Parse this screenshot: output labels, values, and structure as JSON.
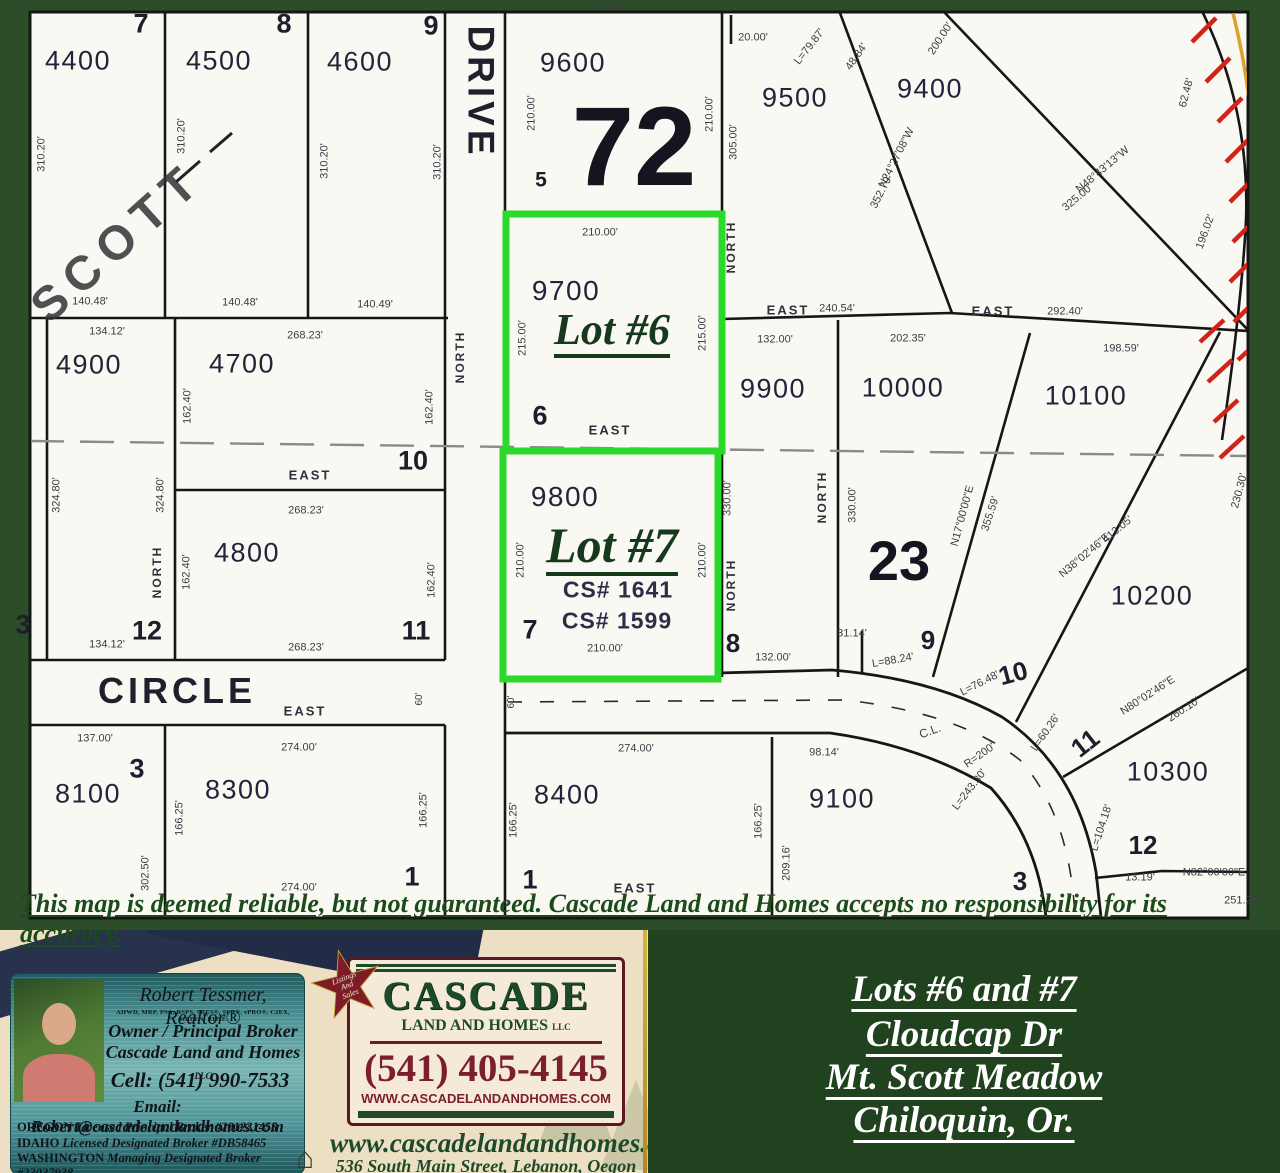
{
  "colors": {
    "frame_green": "#2b4e29",
    "panel_green": "#20421f",
    "paper": "#f9f8f3",
    "line_black": "#161616",
    "highlight_green": "#2bd92b",
    "hatch_red": "#cf2518",
    "boundary_orange": "#dea02b",
    "lot_green_text": "#16391b",
    "maroon": "#7b1f2e",
    "brand_green": "#1c4a2a",
    "cream": "#ecdfc3",
    "card_teal": "#4f9396"
  },
  "map": {
    "disclaimer": "This map is deemed reliable, but not guaranteed. Cascade Land and Homes accepts no responsibility for its accuracy.",
    "highlighted_lots": [
      {
        "label": "Lot #6",
        "parcel": "9700"
      },
      {
        "label": "Lot #7",
        "parcel": "9800"
      }
    ],
    "labels": [
      {
        "t": "DRIVE",
        "x": 481,
        "y": 92,
        "s": 37,
        "r": 90,
        "c": "street"
      },
      {
        "t": "CIRCLE",
        "x": 177,
        "y": 691,
        "s": 36,
        "c": "street"
      },
      {
        "t": "SCOTT",
        "x": 118,
        "y": 243,
        "s": 48,
        "r": -42,
        "c": "scott"
      },
      {
        "t": "4400",
        "x": 78,
        "y": 61,
        "s": 27,
        "c": "parcel"
      },
      {
        "t": "4500",
        "x": 219,
        "y": 61,
        "s": 27,
        "c": "parcel"
      },
      {
        "t": "4600",
        "x": 360,
        "y": 62,
        "s": 27,
        "c": "parcel"
      },
      {
        "t": "9600",
        "x": 573,
        "y": 63,
        "s": 27,
        "c": "parcel"
      },
      {
        "t": "9500",
        "x": 795,
        "y": 98,
        "s": 27,
        "c": "parcel"
      },
      {
        "t": "9400",
        "x": 930,
        "y": 89,
        "s": 27,
        "c": "parcel"
      },
      {
        "t": "9700",
        "x": 566,
        "y": 291,
        "s": 28,
        "c": "parcel"
      },
      {
        "t": "9800",
        "x": 565,
        "y": 497,
        "s": 28,
        "c": "parcel"
      },
      {
        "t": "9900",
        "x": 773,
        "y": 389,
        "s": 27,
        "c": "parcel"
      },
      {
        "t": "10000",
        "x": 903,
        "y": 388,
        "s": 27,
        "c": "parcel"
      },
      {
        "t": "10100",
        "x": 1086,
        "y": 396,
        "s": 27,
        "c": "parcel"
      },
      {
        "t": "10200",
        "x": 1152,
        "y": 596,
        "s": 27,
        "c": "parcel"
      },
      {
        "t": "10300",
        "x": 1168,
        "y": 772,
        "s": 27,
        "c": "parcel"
      },
      {
        "t": "4900",
        "x": 89,
        "y": 365,
        "s": 27,
        "c": "parcel"
      },
      {
        "t": "4700",
        "x": 242,
        "y": 364,
        "s": 27,
        "c": "parcel"
      },
      {
        "t": "4800",
        "x": 247,
        "y": 553,
        "s": 27,
        "c": "parcel"
      },
      {
        "t": "8100",
        "x": 88,
        "y": 794,
        "s": 27,
        "c": "parcel"
      },
      {
        "t": "8300",
        "x": 238,
        "y": 790,
        "s": 27,
        "c": "parcel"
      },
      {
        "t": "8400",
        "x": 567,
        "y": 795,
        "s": 27,
        "c": "parcel"
      },
      {
        "t": "9100",
        "x": 842,
        "y": 799,
        "s": 27,
        "c": "parcel"
      },
      {
        "t": "72",
        "x": 634,
        "y": 147,
        "s": 112,
        "c": "big"
      },
      {
        "t": "23",
        "x": 899,
        "y": 561,
        "s": 56,
        "c": "big"
      },
      {
        "t": "Lot #6",
        "x": 612,
        "y": 330,
        "s": 44,
        "c": "lot"
      },
      {
        "t": "Lot #7",
        "x": 612,
        "y": 545,
        "s": 50,
        "c": "lot"
      },
      {
        "t": "CS# 1641",
        "x": 618,
        "y": 590,
        "s": 23,
        "c": "cs"
      },
      {
        "t": "CS# 1599",
        "x": 617,
        "y": 621,
        "s": 23,
        "c": "cs"
      },
      {
        "t": "7",
        "x": 141,
        "y": 24,
        "s": 27,
        "c": "blk"
      },
      {
        "t": "8",
        "x": 284,
        "y": 24,
        "s": 27,
        "c": "blk"
      },
      {
        "t": "9",
        "x": 431,
        "y": 26,
        "s": 27,
        "c": "blk"
      },
      {
        "t": "5",
        "x": 541,
        "y": 180,
        "s": 21,
        "c": "blk"
      },
      {
        "t": "6",
        "x": 540,
        "y": 416,
        "s": 27,
        "c": "blk"
      },
      {
        "t": "7",
        "x": 530,
        "y": 630,
        "s": 27,
        "c": "blk"
      },
      {
        "t": "10",
        "x": 413,
        "y": 461,
        "s": 27,
        "c": "blk"
      },
      {
        "t": "11",
        "x": 416,
        "y": 631,
        "s": 27,
        "c": "blk"
      },
      {
        "t": "12",
        "x": 147,
        "y": 631,
        "s": 27,
        "c": "blk"
      },
      {
        "t": "3",
        "x": 23,
        "y": 625,
        "s": 27,
        "c": "blk"
      },
      {
        "t": "3",
        "x": 137,
        "y": 769,
        "s": 27,
        "c": "blk"
      },
      {
        "t": "1",
        "x": 412,
        "y": 877,
        "s": 27,
        "c": "blk"
      },
      {
        "t": "1",
        "x": 530,
        "y": 880,
        "s": 27,
        "c": "blk"
      },
      {
        "t": "8",
        "x": 733,
        "y": 643,
        "s": 26,
        "c": "blk"
      },
      {
        "t": "9",
        "x": 928,
        "y": 640,
        "s": 26,
        "c": "blk"
      },
      {
        "t": "10",
        "x": 1013,
        "y": 673,
        "s": 26,
        "r": -15,
        "c": "blk"
      },
      {
        "t": "11",
        "x": 1085,
        "y": 743,
        "s": 26,
        "r": -38,
        "c": "blk"
      },
      {
        "t": "12",
        "x": 1143,
        "y": 845,
        "s": 26,
        "c": "blk"
      },
      {
        "t": "3",
        "x": 1020,
        "y": 881,
        "s": 26,
        "c": "blk"
      },
      {
        "t": "310.20'",
        "x": 42,
        "y": 154,
        "r": -90
      },
      {
        "t": "310.20'",
        "x": 182,
        "y": 136,
        "r": -90
      },
      {
        "t": "310.20'",
        "x": 325,
        "y": 161,
        "r": -90
      },
      {
        "t": "310.20'",
        "x": 438,
        "y": 162,
        "r": -90
      },
      {
        "t": "140.48'",
        "x": 90,
        "y": 302
      },
      {
        "t": "140.48'",
        "x": 240,
        "y": 303
      },
      {
        "t": "140.49'",
        "x": 375,
        "y": 305
      },
      {
        "t": "210.00'",
        "x": 608,
        "y": 7
      },
      {
        "t": "20.00'",
        "x": 753,
        "y": 38
      },
      {
        "t": "210.00'",
        "x": 532,
        "y": 113,
        "r": -90
      },
      {
        "t": "210.00'",
        "x": 710,
        "y": 114,
        "r": -90
      },
      {
        "t": "L=79.87'",
        "x": 810,
        "y": 47,
        "r": -52
      },
      {
        "t": "48.84'",
        "x": 857,
        "y": 57,
        "r": -55
      },
      {
        "t": "200.00'",
        "x": 941,
        "y": 39,
        "r": -57
      },
      {
        "t": "N24°27'08\"W",
        "x": 897,
        "y": 158,
        "r": -63
      },
      {
        "t": "352.79'",
        "x": 882,
        "y": 192,
        "r": -63
      },
      {
        "t": "N48°43'13\"W",
        "x": 1103,
        "y": 170,
        "r": -40
      },
      {
        "t": "325.00'",
        "x": 1078,
        "y": 198,
        "r": -40
      },
      {
        "t": "62.48'",
        "x": 1187,
        "y": 93,
        "r": -75
      },
      {
        "t": "196.02'",
        "x": 1206,
        "y": 232,
        "r": -70
      },
      {
        "t": "305.00'",
        "x": 734,
        "y": 142,
        "r": -90
      },
      {
        "t": "NORTH",
        "x": 731,
        "y": 247,
        "s": 12,
        "r": -90,
        "c": "dir"
      },
      {
        "t": "NORTH",
        "x": 460,
        "y": 357,
        "s": 12,
        "r": -90,
        "c": "dir"
      },
      {
        "t": "EAST",
        "x": 788,
        "y": 310,
        "s": 13,
        "c": "dir"
      },
      {
        "t": "240.54'",
        "x": 837,
        "y": 309
      },
      {
        "t": "EAST",
        "x": 993,
        "y": 311,
        "s": 13,
        "c": "dir"
      },
      {
        "t": "292.40'",
        "x": 1065,
        "y": 312
      },
      {
        "t": "134.12'",
        "x": 107,
        "y": 332
      },
      {
        "t": "268.23'",
        "x": 305,
        "y": 336
      },
      {
        "t": "162.40'",
        "x": 188,
        "y": 406,
        "r": -90
      },
      {
        "t": "162.40'",
        "x": 430,
        "y": 407,
        "r": -90
      },
      {
        "t": "EAST",
        "x": 310,
        "y": 475,
        "s": 13,
        "c": "dir"
      },
      {
        "t": "324.80'",
        "x": 57,
        "y": 495,
        "r": -90
      },
      {
        "t": "324.80'",
        "x": 161,
        "y": 495,
        "r": -90
      },
      {
        "t": "NORTH",
        "x": 157,
        "y": 572,
        "s": 12,
        "r": -90,
        "c": "dir"
      },
      {
        "t": "268.23'",
        "x": 306,
        "y": 511
      },
      {
        "t": "268.23'",
        "x": 306,
        "y": 648
      },
      {
        "t": "162.40'",
        "x": 187,
        "y": 572,
        "r": -90
      },
      {
        "t": "162.40'",
        "x": 432,
        "y": 580,
        "r": -90
      },
      {
        "t": "134.12'",
        "x": 107,
        "y": 645
      },
      {
        "t": "210.00'",
        "x": 600,
        "y": 233
      },
      {
        "t": "215.00'",
        "x": 523,
        "y": 338,
        "r": -90
      },
      {
        "t": "215.00'",
        "x": 703,
        "y": 333,
        "r": -90
      },
      {
        "t": "EAST",
        "x": 610,
        "y": 430,
        "s": 13,
        "c": "dir"
      },
      {
        "t": "210.00'",
        "x": 521,
        "y": 560,
        "r": -90
      },
      {
        "t": "210.00'",
        "x": 703,
        "y": 560,
        "r": -90
      },
      {
        "t": "210.00'",
        "x": 605,
        "y": 649
      },
      {
        "t": "330.00'",
        "x": 728,
        "y": 498,
        "r": -90
      },
      {
        "t": "NORTH",
        "x": 731,
        "y": 585,
        "s": 12,
        "r": -90,
        "c": "dir"
      },
      {
        "t": "132.00'",
        "x": 773,
        "y": 658
      },
      {
        "t": "132.00'",
        "x": 775,
        "y": 340
      },
      {
        "t": "NORTH",
        "x": 822,
        "y": 497,
        "s": 12,
        "r": -90,
        "c": "dir"
      },
      {
        "t": "330.00'",
        "x": 853,
        "y": 505,
        "r": -90
      },
      {
        "t": "202.35'",
        "x": 908,
        "y": 339
      },
      {
        "t": "198.59'",
        "x": 1121,
        "y": 349
      },
      {
        "t": "N17°00'00\"E",
        "x": 963,
        "y": 516,
        "r": -75
      },
      {
        "t": "355.59'",
        "x": 991,
        "y": 514,
        "r": -72
      },
      {
        "t": "N38°02'46\"E",
        "x": 1085,
        "y": 556,
        "r": -40
      },
      {
        "t": "413.05'",
        "x": 1118,
        "y": 530,
        "r": -40
      },
      {
        "t": "230.30'",
        "x": 1240,
        "y": 491,
        "r": -75
      },
      {
        "t": "31.14'",
        "x": 852,
        "y": 634
      },
      {
        "t": "L=88.24'",
        "x": 893,
        "y": 661,
        "r": -10
      },
      {
        "t": "L=76.48'",
        "x": 980,
        "y": 684,
        "r": -27
      },
      {
        "t": "L=60.26'",
        "x": 1046,
        "y": 733,
        "r": -55
      },
      {
        "t": "N80°02'46\"E",
        "x": 1148,
        "y": 696,
        "r": -33
      },
      {
        "t": "260.10'",
        "x": 1184,
        "y": 710,
        "r": -33
      },
      {
        "t": "C.L.",
        "x": 930,
        "y": 731,
        "s": 12,
        "r": -20
      },
      {
        "t": "R=200'",
        "x": 980,
        "y": 756,
        "r": -35
      },
      {
        "t": "L=243.30'",
        "x": 970,
        "y": 790,
        "r": -52
      },
      {
        "t": "L=104.18'",
        "x": 1102,
        "y": 828,
        "r": -72
      },
      {
        "t": "13.19'",
        "x": 1140,
        "y": 878
      },
      {
        "t": "N82°00'00\"E",
        "x": 1214,
        "y": 873
      },
      {
        "t": "251.23'",
        "x": 1242,
        "y": 901
      },
      {
        "t": "98.14'",
        "x": 824,
        "y": 753
      },
      {
        "t": "209.16'",
        "x": 787,
        "y": 863,
        "r": -90
      },
      {
        "t": "166.25'",
        "x": 759,
        "y": 821,
        "r": -90
      },
      {
        "t": "166.25'",
        "x": 514,
        "y": 820,
        "r": -90
      },
      {
        "t": "274.00'",
        "x": 636,
        "y": 749
      },
      {
        "t": "EAST",
        "x": 635,
        "y": 888,
        "s": 13,
        "c": "dir"
      },
      {
        "t": "274.00'",
        "x": 299,
        "y": 888
      },
      {
        "t": "60'",
        "x": 420,
        "y": 699,
        "s": 10,
        "r": -90
      },
      {
        "t": "60'",
        "x": 512,
        "y": 702,
        "s": 10,
        "r": -90
      },
      {
        "t": "EAST",
        "x": 305,
        "y": 711,
        "s": 13,
        "c": "dir"
      },
      {
        "t": "137.00'",
        "x": 95,
        "y": 739
      },
      {
        "t": "302.50'",
        "x": 146,
        "y": 873,
        "r": -90
      },
      {
        "t": "166.25'",
        "x": 180,
        "y": 818,
        "r": -90
      },
      {
        "t": "166.25'",
        "x": 424,
        "y": 810,
        "r": -90
      },
      {
        "t": "274.00'",
        "x": 299,
        "y": 748
      }
    ]
  },
  "banner": {
    "left_card": {
      "name": "Robert Tessmer, Realtor®",
      "credentials": "AHWD, MRP, PSA, RSPS, SRES®, SFR®, ePRO®, C2EX, GREEN, RENE",
      "title1": "Owner / Principal Broker",
      "title2": "Cascade Land and Homes",
      "title2_suffix": "LLC",
      "cell": "Cell: (541) 990-7533",
      "email": "Email: Robert@cascadelandandhomes.com",
      "licenses": [
        {
          "state": "OREGON",
          "rest": " Licensed Principal Broker #201231455"
        },
        {
          "state": "IDAHO",
          "rest": " Licensed Designated Broker #DB58465"
        },
        {
          "state": "WASHINGTON",
          "rest": " Managing Designated Broker #23037938"
        }
      ]
    },
    "center_card": {
      "badge_lines": [
        "Listings",
        "And",
        "Sales"
      ],
      "brand": "CASCADE",
      "brand_sub": "LAND AND HOMES",
      "brand_suffix": "LLC",
      "phone": "(541) 405-4145",
      "site_caps": "WWW.CASCADELANDANDHOMES.COM",
      "site": "www.cascadelandandhomes.com",
      "address": "536 South Main Street, Lebanon, Oegon 97355"
    },
    "right_panel": {
      "lines": [
        "Lots #6 and #7",
        "Cloudcap Dr",
        "Mt. Scott Meadow",
        "Chiloquin,  Or."
      ]
    }
  }
}
